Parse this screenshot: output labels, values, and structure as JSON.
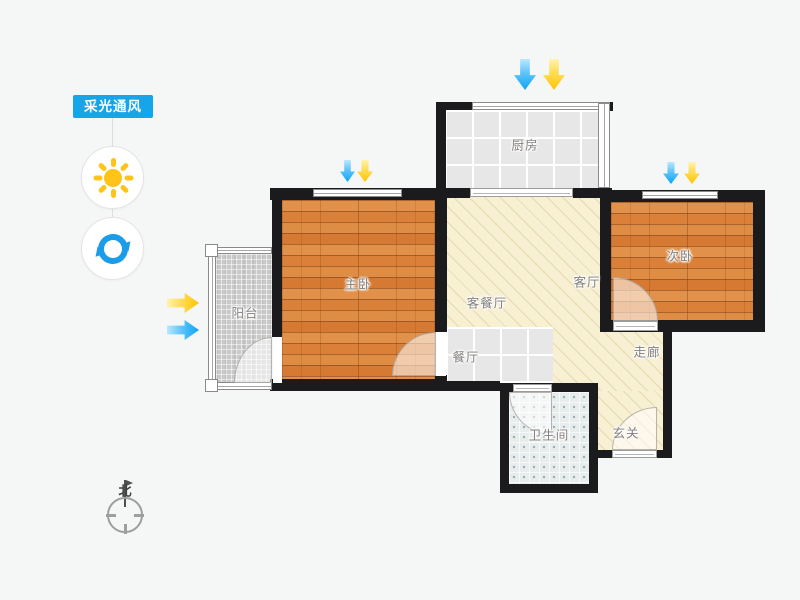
{
  "sidebar": {
    "title": "采光通风",
    "accent_color": "#14A5EB",
    "tools": [
      {
        "id": "sunlight",
        "icon": "sun-icon",
        "color": "#FFC417"
      },
      {
        "id": "ventilation",
        "icon": "refresh-icon",
        "color": "#1B9CE9"
      }
    ]
  },
  "compass": {
    "north_label": "北"
  },
  "floorplan": {
    "rooms": {
      "kitchen": {
        "label": "厨房",
        "floor": "gray-tile"
      },
      "master_bedroom": {
        "label": "主卧",
        "floor": "wood"
      },
      "second_bedroom": {
        "label": "次卧",
        "floor": "wood"
      },
      "living_dining": {
        "label": "客餐厅",
        "floor": "beige-hatch"
      },
      "living": {
        "label": "客厅",
        "floor": "beige-hatch"
      },
      "dining": {
        "label": "餐厅",
        "floor": "gray-tile"
      },
      "corridor": {
        "label": "走廊",
        "floor": "beige-hatch"
      },
      "entry": {
        "label": "玄关",
        "floor": "beige-hatch"
      },
      "bathroom": {
        "label": "卫生间",
        "floor": "dot-tile"
      },
      "balcony": {
        "label": "阳台",
        "floor": "speckle-tile"
      }
    },
    "arrows": [
      {
        "at": "kitchen-top",
        "direction": "down",
        "colors": [
          "blue",
          "yellow"
        ]
      },
      {
        "at": "master-bedroom-top",
        "direction": "down",
        "colors": [
          "blue",
          "yellow"
        ]
      },
      {
        "at": "second-bedroom-top",
        "direction": "down",
        "colors": [
          "blue",
          "yellow"
        ]
      },
      {
        "at": "balcony-left",
        "direction": "right",
        "colors": [
          "yellow",
          "blue"
        ]
      }
    ],
    "colors": {
      "wall": "#1B1B1D",
      "arrow_blue": "#0AA5F4",
      "arrow_yellow": "#FFC400",
      "wood_floor": "#DE8A41",
      "beige_floor": "#F8F0D3",
      "gray_tile_floor": "#E7E7E7",
      "bath_tile_floor": "#E6EDEC",
      "balcony_floor": "#C9C9C9"
    }
  }
}
